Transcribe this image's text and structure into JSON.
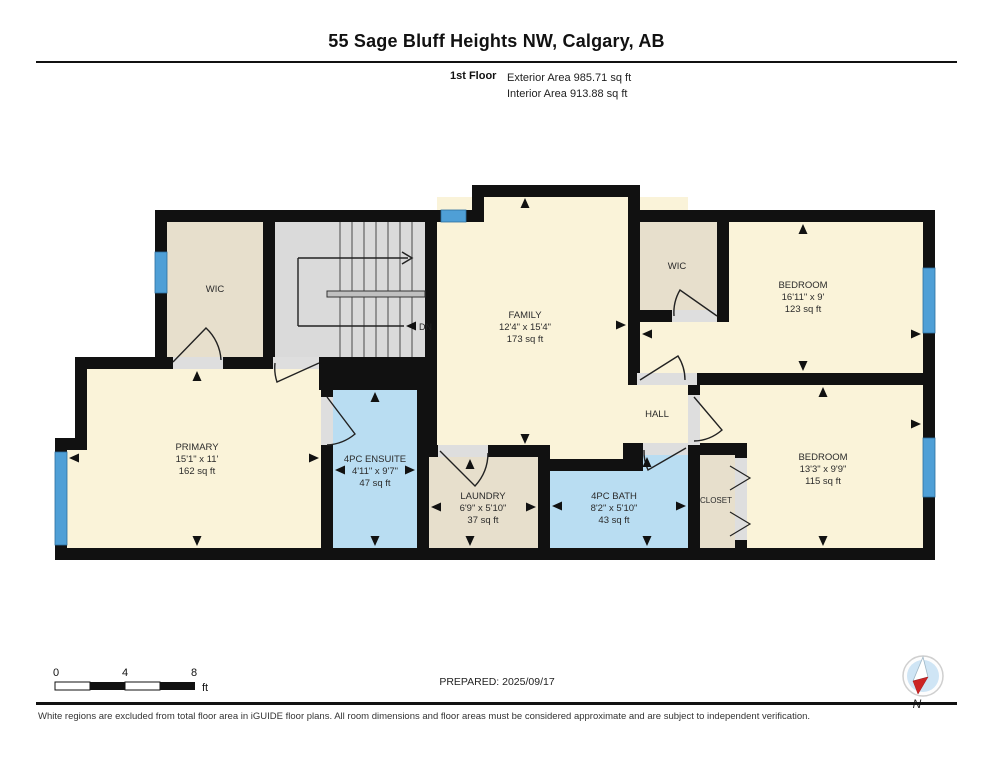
{
  "header": {
    "title": "55 Sage Bluff Heights NW, Calgary, AB",
    "floor_label": "1st Floor",
    "exterior_area": "Exterior Area 985.71 sq ft",
    "interior_area": "Interior Area 913.88 sq ft"
  },
  "rooms": {
    "family": {
      "name": "FAMILY",
      "dims": "12'4\" x 15'4\"",
      "area": "173 sq ft"
    },
    "primary": {
      "name": "PRIMARY",
      "dims": "15'1\" x 11'",
      "area": "162 sq ft"
    },
    "ensuite": {
      "name": "4PC ENSUITE",
      "dims": "4'11\" x 9'7\"",
      "area": "47 sq ft"
    },
    "laundry": {
      "name": "LAUNDRY",
      "dims": "6'9\" x 5'10\"",
      "area": "37 sq ft"
    },
    "bath": {
      "name": "4PC BATH",
      "dims": "8'2\" x 5'10\"",
      "area": "43 sq ft"
    },
    "bedroom_upper": {
      "name": "BEDROOM",
      "dims": "16'11\" x 9'",
      "area": "123 sq ft"
    },
    "bedroom_lower": {
      "name": "BEDROOM",
      "dims": "13'3\" x 9'9\"",
      "area": "115 sq ft"
    },
    "wic_left": {
      "name": "WIC"
    },
    "wic_right": {
      "name": "WIC"
    },
    "hall": {
      "name": "HALL"
    },
    "closet": {
      "name": "CLOSET"
    },
    "stairs": {
      "down_label": "DN"
    }
  },
  "scale_bar": {
    "labels": [
      "0",
      "4",
      "8"
    ],
    "unit": "ft"
  },
  "footer": {
    "prepared": "PREPARED: 2025/09/17",
    "compass_label": "N",
    "disclaimer": "White regions are excluded from total floor area in iGUIDE floor plans. All room dimensions and floor areas must be considered approximate and are subject to independent verification."
  },
  "colors": {
    "wall": "#111111",
    "window_blue": "#4f9fd6",
    "room_blue": "#b9ddf2",
    "room_cream": "#faf3d9",
    "room_tan": "#e7dfcc",
    "stairs_gray": "#dadada",
    "compass_red": "#cc2424"
  }
}
